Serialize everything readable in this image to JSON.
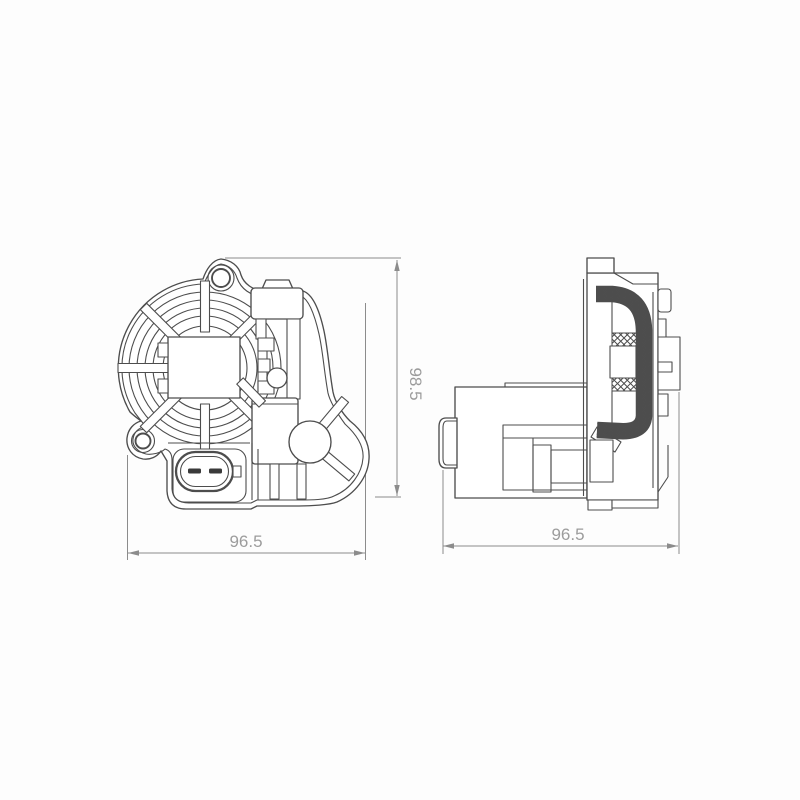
{
  "drawing": {
    "title": "two-view technical drawing of actuator part",
    "front_view": {
      "width_dim": "96.5",
      "height_dim": "98.5"
    },
    "side_view": {
      "width_dim": "96.5"
    },
    "colors": {
      "part-line": "#4d4d4d",
      "dim-line": "#8c8c8c",
      "dim-text": "#9c9c9c",
      "pin-fill": "#3a3a3a",
      "background": "#fdfdfd"
    }
  }
}
